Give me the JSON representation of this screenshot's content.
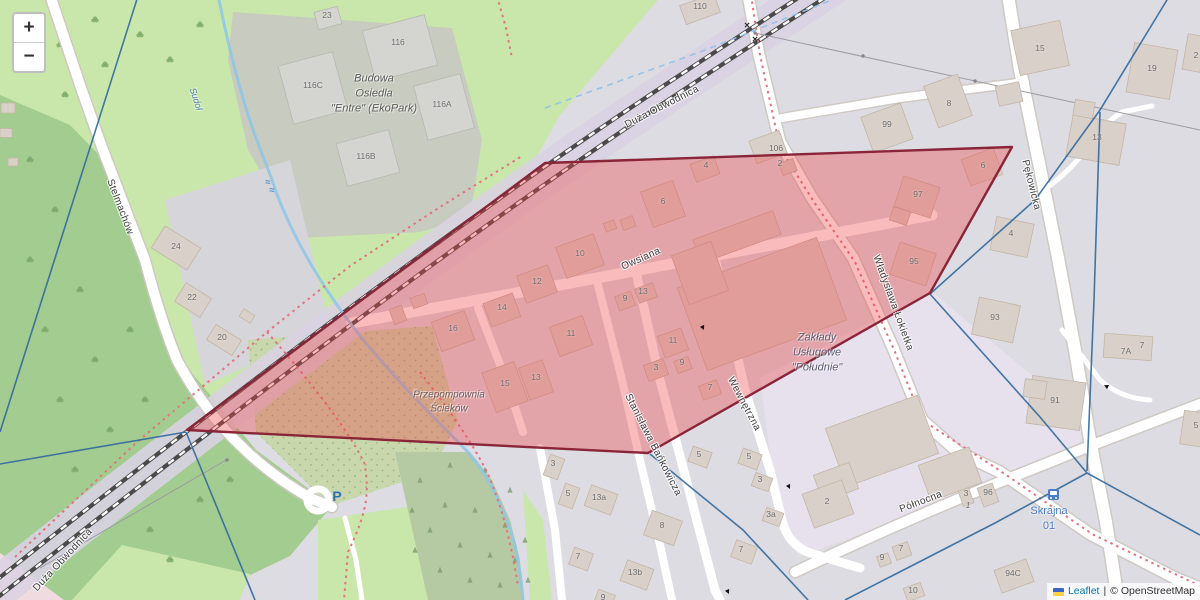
{
  "map": {
    "controls": {
      "zoom_in": "+",
      "zoom_out": "−"
    },
    "attribution": {
      "leaflet_label": "Leaflet",
      "separator": "|",
      "osm_label": "© OpenStreetMap",
      "flag_top_color": "#3e64c4",
      "flag_bottom_color": "#fbd244"
    },
    "overlay": {
      "polygon_points": "545,163 1012,147 930,293 648,453 187,430",
      "fill": "rgba(237,66,70,0.36)",
      "stroke": "#8a2438"
    },
    "street_labels": [
      {
        "t": "Duża Obwodnica",
        "x": 662,
        "y": 107,
        "r": -27
      },
      {
        "t": "Duża Obwodnica",
        "x": 63,
        "y": 560,
        "r": -47
      },
      {
        "t": "Stelmachów",
        "x": 120,
        "y": 207,
        "r": 69
      },
      {
        "t": "Owsiana",
        "x": 641,
        "y": 259,
        "r": -24
      },
      {
        "t": "Władysława Łokietka",
        "x": 893,
        "y": 303,
        "r": 70
      },
      {
        "t": "Pękowicka",
        "x": 1031,
        "y": 185,
        "r": 76
      },
      {
        "t": "Stanisława Bańkowicza",
        "x": 653,
        "y": 445,
        "r": 63
      },
      {
        "t": "Wewnętrzna",
        "x": 744,
        "y": 404,
        "r": 62
      },
      {
        "t": "Północna",
        "x": 921,
        "y": 502,
        "r": -21
      }
    ],
    "place_labels": [
      {
        "lines": [
          "Budowa",
          "Osiedla",
          "\"Entre\" (EkoPark)"
        ],
        "x": 374,
        "y": 94,
        "c": "#5c5c5c",
        "i": 1,
        "s": 11,
        "r": 0
      },
      {
        "lines": [
          "Przepompownia",
          "Ścieków"
        ],
        "x": 449,
        "y": 402,
        "c": "#6e5f5f",
        "i": 1,
        "s": 10,
        "r": 0
      },
      {
        "lines": [
          "Zakłady",
          "Usługowe",
          "\"Południe\""
        ],
        "x": 817,
        "y": 353,
        "c": "#5f5f76",
        "i": 1,
        "s": 11,
        "r": 0
      },
      {
        "lines": [
          "Skrajna",
          "01"
        ],
        "x": 1049,
        "y": 519,
        "c": "#4a7ec7",
        "i": 0,
        "s": 11,
        "r": 0
      },
      {
        "lines": [
          "Sudoł"
        ],
        "x": 196,
        "y": 99,
        "c": "#4f7fae",
        "i": 1,
        "s": 9,
        "r": 72
      }
    ],
    "house_numbers": [
      {
        "t": "23",
        "x": 327,
        "y": 15
      },
      {
        "t": "116",
        "x": 398,
        "y": 42
      },
      {
        "t": "116C",
        "x": 313,
        "y": 85
      },
      {
        "t": "116A",
        "x": 442,
        "y": 104
      },
      {
        "t": "116B",
        "x": 366,
        "y": 156
      },
      {
        "t": "110",
        "x": 700,
        "y": 6
      },
      {
        "t": "106",
        "x": 776,
        "y": 148
      },
      {
        "t": "2",
        "x": 780,
        "y": 163
      },
      {
        "t": "4",
        "x": 706,
        "y": 165
      },
      {
        "t": "6",
        "x": 663,
        "y": 201
      },
      {
        "t": "99",
        "x": 887,
        "y": 124
      },
      {
        "t": "8",
        "x": 949,
        "y": 103
      },
      {
        "t": "15",
        "x": 1040,
        "y": 48
      },
      {
        "t": "19",
        "x": 1152,
        "y": 68
      },
      {
        "t": "2",
        "x": 1196,
        "y": 55
      },
      {
        "t": "13",
        "x": 1097,
        "y": 137
      },
      {
        "t": "6",
        "x": 983,
        "y": 165
      },
      {
        "t": "97",
        "x": 918,
        "y": 194
      },
      {
        "t": "95",
        "x": 914,
        "y": 261
      },
      {
        "t": "4",
        "x": 1011,
        "y": 233
      },
      {
        "t": "93",
        "x": 995,
        "y": 317
      },
      {
        "t": "7A",
        "x": 1126,
        "y": 351
      },
      {
        "t": "7",
        "x": 1142,
        "y": 345
      },
      {
        "t": "91",
        "x": 1055,
        "y": 400
      },
      {
        "t": "5",
        "x": 1196,
        "y": 425
      },
      {
        "t": "24",
        "x": 176,
        "y": 246
      },
      {
        "t": "22",
        "x": 192,
        "y": 297
      },
      {
        "t": "20",
        "x": 222,
        "y": 337
      },
      {
        "t": "16",
        "x": 453,
        "y": 328
      },
      {
        "t": "14",
        "x": 502,
        "y": 307
      },
      {
        "t": "12",
        "x": 537,
        "y": 281
      },
      {
        "t": "10",
        "x": 580,
        "y": 253
      },
      {
        "t": "9",
        "x": 625,
        "y": 298
      },
      {
        "t": "13",
        "x": 643,
        "y": 291
      },
      {
        "t": "11",
        "x": 571,
        "y": 333
      },
      {
        "t": "15",
        "x": 505,
        "y": 383
      },
      {
        "t": "13",
        "x": 536,
        "y": 377
      },
      {
        "t": "11",
        "x": 673,
        "y": 340
      },
      {
        "t": "3",
        "x": 656,
        "y": 367
      },
      {
        "t": "9",
        "x": 682,
        "y": 362
      },
      {
        "t": "7",
        "x": 710,
        "y": 387
      },
      {
        "t": "5",
        "x": 699,
        "y": 454
      },
      {
        "t": "5",
        "x": 749,
        "y": 456
      },
      {
        "t": "3",
        "x": 760,
        "y": 479
      },
      {
        "t": "3a",
        "x": 771,
        "y": 514
      },
      {
        "t": "7",
        "x": 741,
        "y": 549
      },
      {
        "t": "2",
        "x": 827,
        "y": 501
      },
      {
        "t": "3",
        "x": 553,
        "y": 463
      },
      {
        "t": "5",
        "x": 568,
        "y": 493
      },
      {
        "t": "13a",
        "x": 599,
        "y": 497
      },
      {
        "t": "8",
        "x": 662,
        "y": 525
      },
      {
        "t": "7",
        "x": 578,
        "y": 556
      },
      {
        "t": "13b",
        "x": 635,
        "y": 572
      },
      {
        "t": "9",
        "x": 603,
        "y": 597
      },
      {
        "t": "96",
        "x": 988,
        "y": 492
      },
      {
        "t": "3",
        "x": 966,
        "y": 493
      },
      {
        "t": "1",
        "x": 968,
        "y": 505,
        "i": 1
      },
      {
        "t": "94C",
        "x": 1013,
        "y": 573
      },
      {
        "t": "7",
        "x": 901,
        "y": 548
      },
      {
        "t": "9",
        "x": 882,
        "y": 557
      },
      {
        "t": "10",
        "x": 913,
        "y": 590
      }
    ],
    "symbols": [
      {
        "t": "P",
        "x": 337,
        "y": 496,
        "s": 14,
        "c": "#2a6fc0",
        "b": 1,
        "name": "parking-icon"
      },
      {
        "t": "≈",
        "x": 268,
        "y": 182,
        "s": 9,
        "c": "#4a90c8",
        "b": 1,
        "name": "weir-icon"
      },
      {
        "t": "≈",
        "x": 272,
        "y": 190,
        "s": 9,
        "c": "#4a90c8",
        "b": 1,
        "name": "weir-icon"
      },
      {
        "t": "×",
        "x": 747,
        "y": 26,
        "s": 10,
        "c": "#2b2b2b",
        "b": 1,
        "name": "level-crossing-icon"
      },
      {
        "t": "×",
        "x": 755,
        "y": 40,
        "s": 10,
        "c": "#2b2b2b",
        "b": 1,
        "name": "level-crossing-icon"
      },
      {
        "t": "▶",
        "x": 789,
        "y": 487,
        "s": 6,
        "c": "#111111",
        "r": 65,
        "name": "oneway-arrow-icon"
      },
      {
        "t": "▶",
        "x": 703,
        "y": 328,
        "s": 6,
        "c": "#111111",
        "r": 65,
        "name": "oneway-arrow-icon"
      },
      {
        "t": "▶",
        "x": 728,
        "y": 592,
        "s": 6,
        "c": "#111111",
        "r": 65,
        "name": "oneway-arrow-icon"
      },
      {
        "t": "▶",
        "x": 1106,
        "y": 386,
        "s": 6,
        "c": "#111111",
        "r": 205,
        "name": "oneway-arrow-icon"
      }
    ]
  }
}
